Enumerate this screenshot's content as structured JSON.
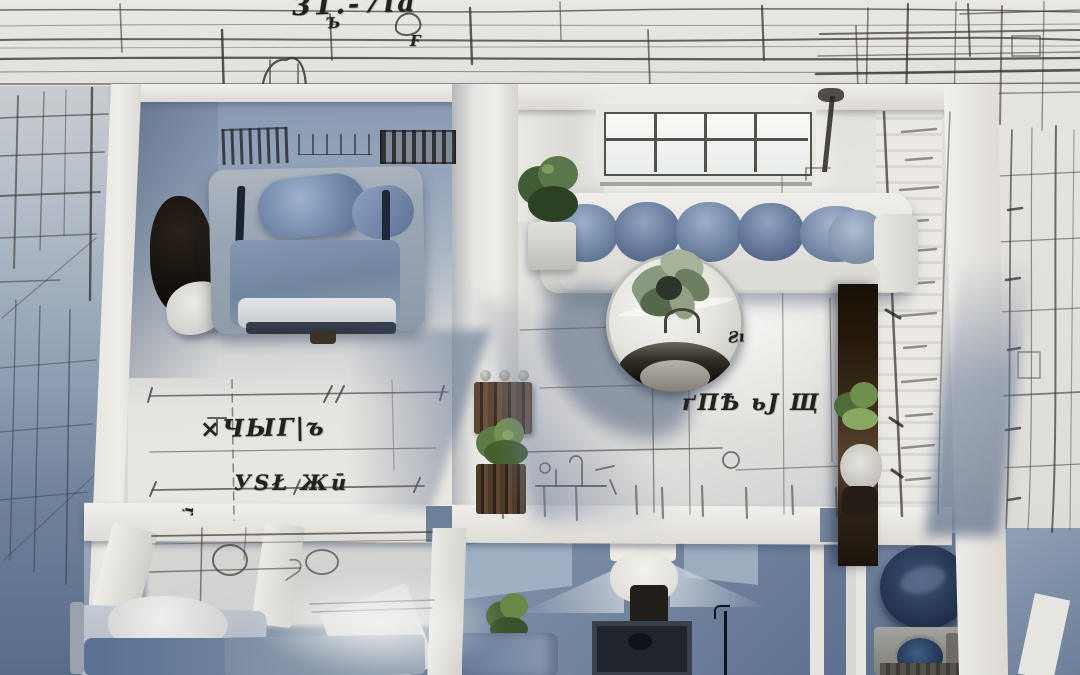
{
  "scene": {
    "type": "aerial-floorplan-render",
    "description": "Top-down 3D rendered apartment model over hand-sketched blueprint paper"
  },
  "annotations": {
    "top_title": "31.-7ia",
    "top_mark_left": "Ъ",
    "top_mark_right": "Ϝ",
    "left_room_note_1": "×ЧЫГ|ъ",
    "left_room_note_2": "УЅŁ Жū",
    "left_room_tick": "ŗ",
    "right_room_note": "ґПѢ ьЈ Щ",
    "right_room_mark": "Ƨı"
  },
  "palette": {
    "paper": "#dcdbd7",
    "ink": "#3a362f",
    "wall_white": "#edebe6",
    "shadow_blue": "#64799b",
    "deep_navy": "#1c2128",
    "sofa_blue": "#7f95b5",
    "wood_brown": "#4a3826",
    "plant_green": "#5d7a45",
    "window_light": "#f7f8f6"
  },
  "objects": [
    "bed",
    "sofa",
    "round-table",
    "potted-plants",
    "toilet",
    "washing-machine",
    "pouf",
    "window",
    "bottle-crate",
    "wood-shelf"
  ]
}
